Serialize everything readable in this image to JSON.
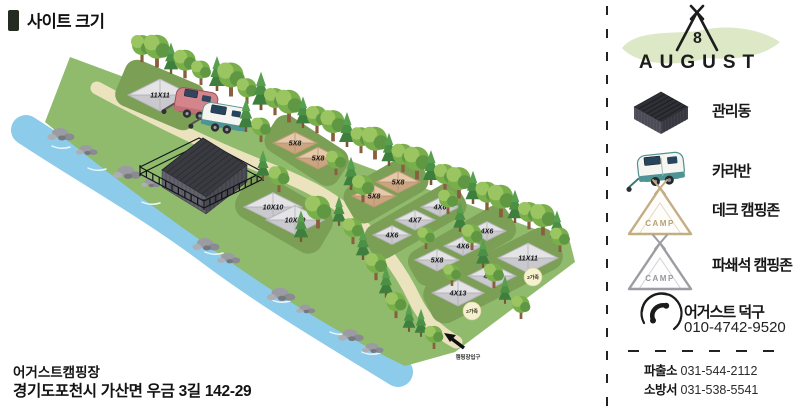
{
  "title": "사이트 크기",
  "footer": {
    "campground_name": "어거스트캠핑장",
    "address": "경기도포천시 가산면 우금 3길 142-29"
  },
  "map": {
    "sites": [
      {
        "label": "11X11",
        "type": "gravel"
      },
      {
        "label": "5X8",
        "type": "deck"
      },
      {
        "label": "5X8",
        "type": "deck"
      },
      {
        "label": "5X8",
        "type": "deck"
      },
      {
        "label": "5X8",
        "type": "deck"
      },
      {
        "label": "10X10",
        "type": "gravel"
      },
      {
        "label": "10X10",
        "type": "gravel"
      },
      {
        "label": "4X6",
        "type": "gravel"
      },
      {
        "label": "4X7",
        "type": "gravel"
      },
      {
        "label": "4X6",
        "type": "gravel"
      },
      {
        "label": "4X6",
        "type": "gravel"
      },
      {
        "label": "4X6",
        "type": "gravel"
      },
      {
        "label": "5X8",
        "type": "gravel"
      },
      {
        "label": "11X11",
        "type": "gravel"
      },
      {
        "label": "4X10",
        "type": "gravel"
      },
      {
        "label": "4X13",
        "type": "gravel"
      }
    ],
    "badges": [
      {
        "label": "2가족"
      },
      {
        "label": "2가족"
      }
    ],
    "entrance_label": "캠핑장입구"
  },
  "panel": {
    "logo": {
      "name": "AUGUST",
      "tent_number": "8"
    },
    "legend": [
      {
        "label": "관리동"
      },
      {
        "label": "카라반"
      },
      {
        "label": "데크 캠핑존"
      },
      {
        "label": "파쇄석 캠핑존"
      }
    ],
    "camp_text": "CAMP",
    "contact": {
      "label": "어거스트 덕구",
      "phone": "010-4742-9520"
    },
    "emergency": [
      {
        "label": "파출소",
        "phone": "031-544-2112"
      },
      {
        "label": "소방서",
        "phone": "031-538-5541"
      }
    ]
  },
  "colors": {
    "grass": "#90BB6D",
    "river": "#8CCBE9",
    "road": "#EAE3BD",
    "pad": "#7C9F56",
    "site_gravel": "#D9D9DC",
    "site_deck": "#D9B996",
    "accent_teal": "#4F9494",
    "logo_blob": "#DDE8C6",
    "building": "#3A3A41"
  }
}
